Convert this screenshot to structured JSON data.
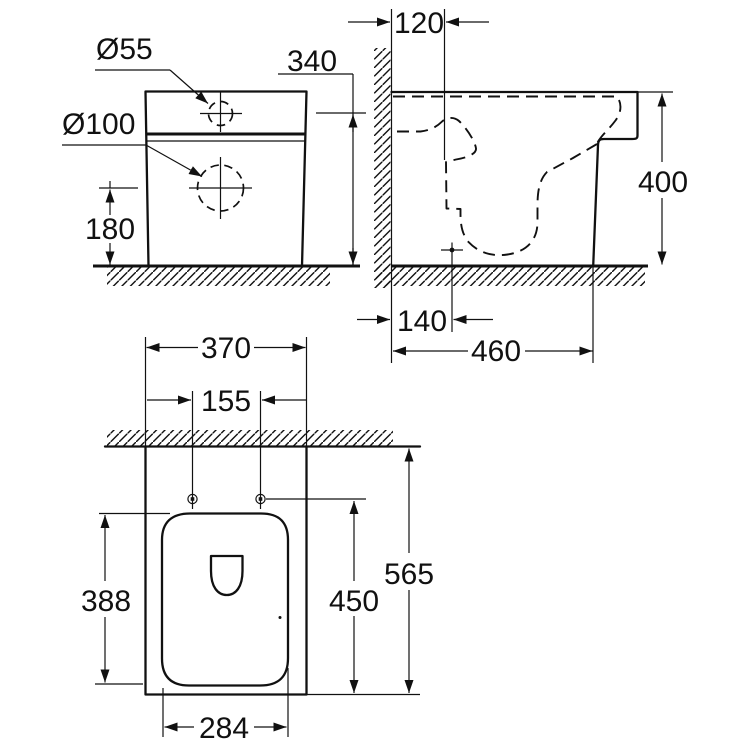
{
  "drawing": {
    "front_view": {
      "hole_top_label": "Ø55",
      "hole_mid_label": "Ø100",
      "dim_spud_height": "340",
      "dim_drain_height": "180"
    },
    "side_view": {
      "dim_wall_offset": "120",
      "dim_height": "400",
      "dim_drain_from_wall": "140",
      "dim_depth": "460"
    },
    "plan_view": {
      "dim_width": "370",
      "dim_hole_spacing": "155",
      "dim_bowl_length": "388",
      "dim_holes_to_front": "450",
      "dim_total_depth": "565",
      "dim_bowl_width": "284"
    }
  },
  "colors": {
    "ink": "#111111",
    "paper": "#ffffff"
  }
}
